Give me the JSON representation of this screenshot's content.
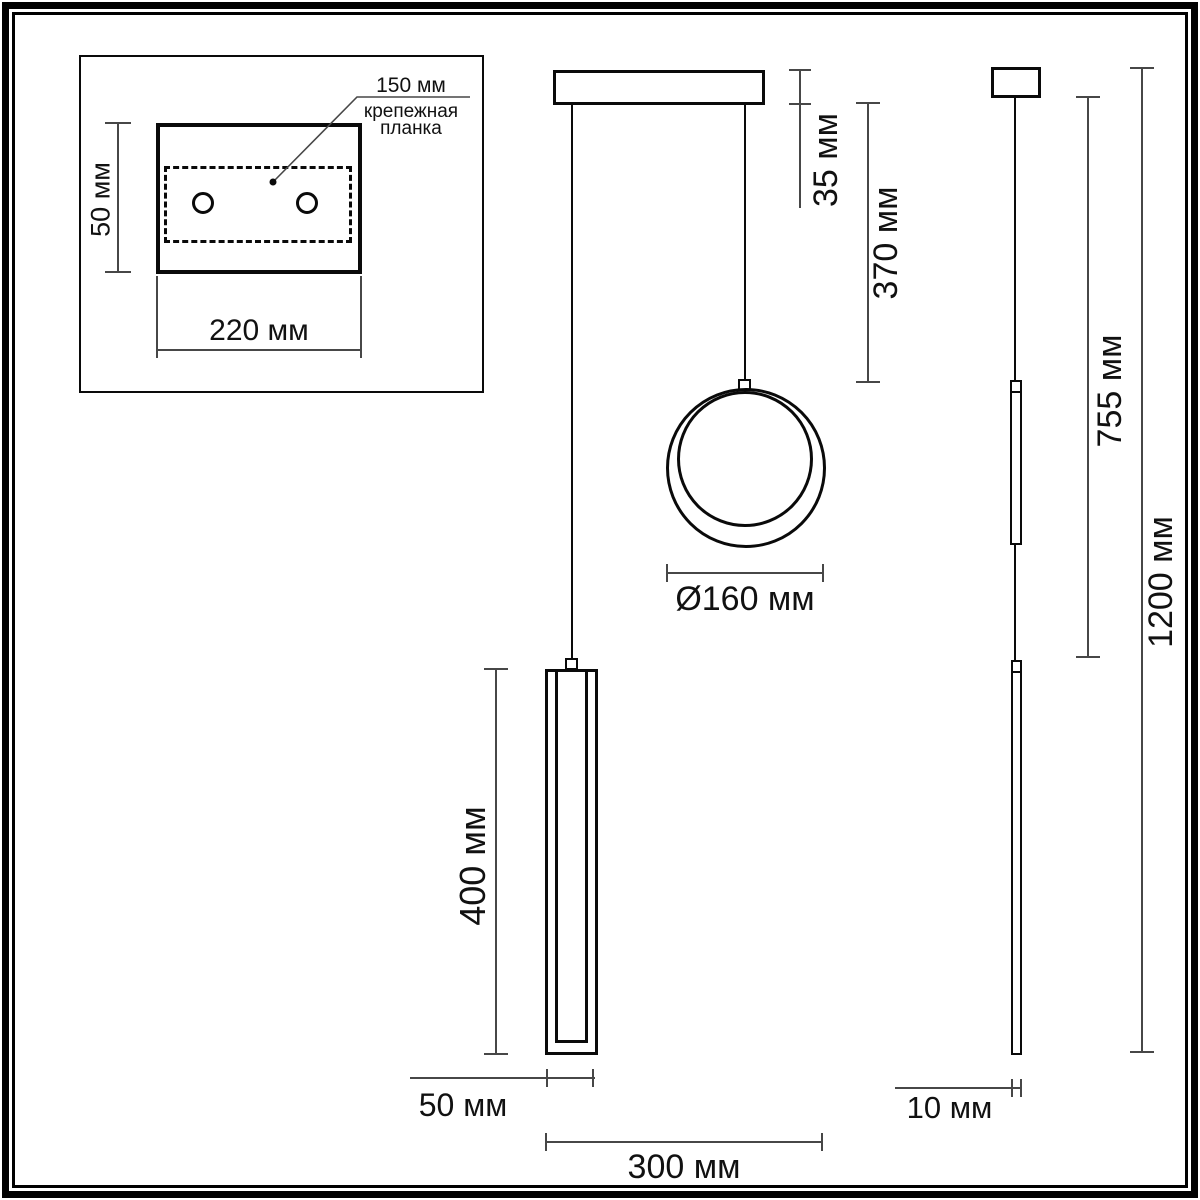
{
  "drawing_title": "pendant-light-dimension-drawing",
  "units": "мм",
  "colors": {
    "line": "#0a0a0a",
    "dimension": "#474747",
    "background": "#ffffff"
  },
  "inset": {
    "hole_spacing_label": "150 мм",
    "plate_label_line1": "крепежная",
    "plate_label_line2": "планка",
    "height_label": "50 мм",
    "width_label": "220 мм"
  },
  "front_view": {
    "canopy_height_label": "35 мм",
    "cord_length_label": "370 мм",
    "ring_diameter_label": "Ø160 мм",
    "bar_length_label": "400 мм",
    "bar_width_label": "50 мм",
    "total_width_label": "300 мм"
  },
  "side_view": {
    "drop_to_bar_label": "755 мм",
    "total_height_label": "1200 мм",
    "bar_depth_label": "10 мм"
  }
}
